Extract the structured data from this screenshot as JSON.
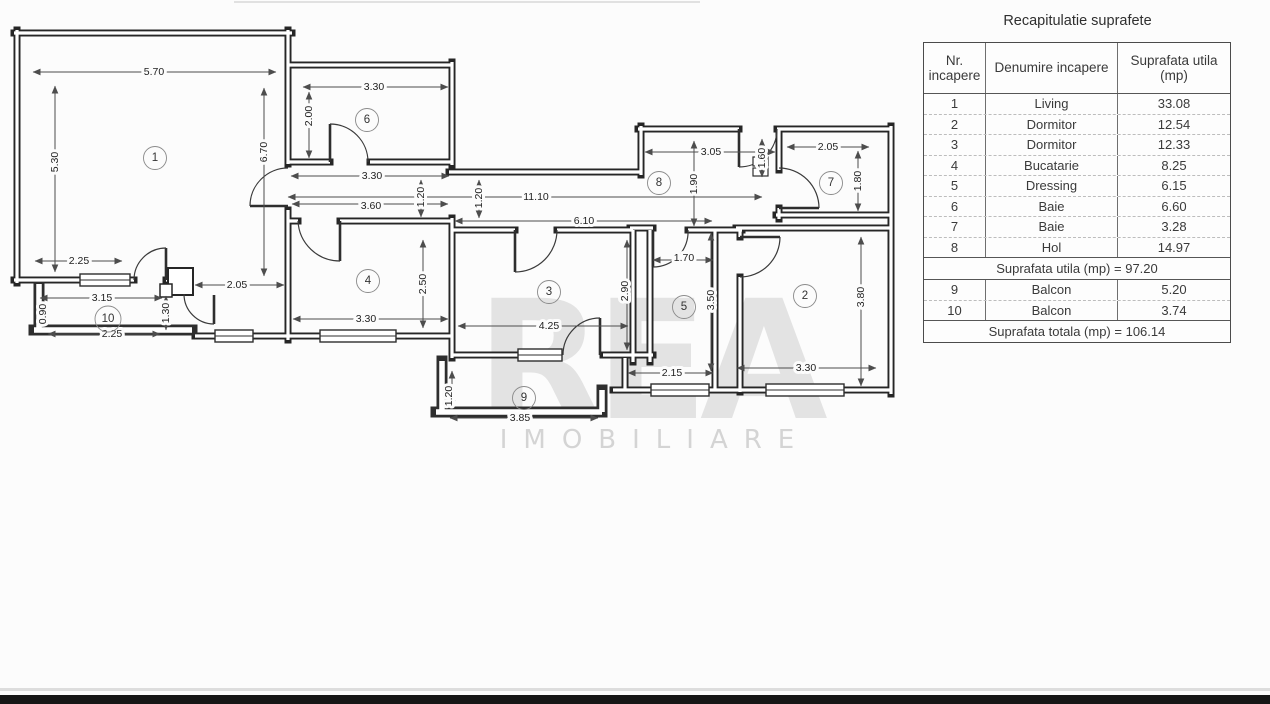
{
  "plan": {
    "rooms": [
      "1",
      "2",
      "3",
      "4",
      "5",
      "6",
      "7",
      "8",
      "9",
      "10"
    ],
    "dims": [
      "5.70",
      "5.30",
      "6.70",
      "2.25",
      "2.05",
      "3.15",
      "0.90",
      "1.30",
      "2.25",
      "3.30",
      "2.00",
      "3.30",
      "1.20",
      "11.10",
      "3.60",
      "1.20",
      "6.10",
      "3.05",
      "1.90",
      "1.60",
      "2.05",
      "1.80",
      "3.80",
      "3.30",
      "1.70",
      "3.50",
      "2.15",
      "2.90",
      "4.25",
      "2.50",
      "3.30",
      "1.20",
      "3.85"
    ],
    "watermark": {
      "big": "REA",
      "small": "IMOBILIARE"
    }
  },
  "table": {
    "title": "Recapitulatie suprafete",
    "headers": {
      "col1": "Nr. incapere",
      "col2": "Denumire incapere",
      "col3": "Suprafata utila (mp)"
    },
    "rows": [
      {
        "nr": "1",
        "name": "Living",
        "area": "33.08"
      },
      {
        "nr": "2",
        "name": "Dormitor",
        "area": "12.54"
      },
      {
        "nr": "3",
        "name": "Dormitor",
        "area": "12.33"
      },
      {
        "nr": "4",
        "name": "Bucatarie",
        "area": "8.25"
      },
      {
        "nr": "5",
        "name": "Dressing",
        "area": "6.15"
      },
      {
        "nr": "6",
        "name": "Baie",
        "area": "6.60"
      },
      {
        "nr": "7",
        "name": "Baie",
        "area": "3.28"
      },
      {
        "nr": "8",
        "name": "Hol",
        "area": "14.97"
      }
    ],
    "subtotal": {
      "label": "Suprafata utila (mp) =",
      "value": "97.20"
    },
    "rows2": [
      {
        "nr": "9",
        "name": "Balcon",
        "area": "5.20"
      },
      {
        "nr": "10",
        "name": "Balcon",
        "area": "3.74"
      }
    ],
    "total": {
      "label": "Suprafata totala (mp) =",
      "value": "106.14"
    }
  }
}
